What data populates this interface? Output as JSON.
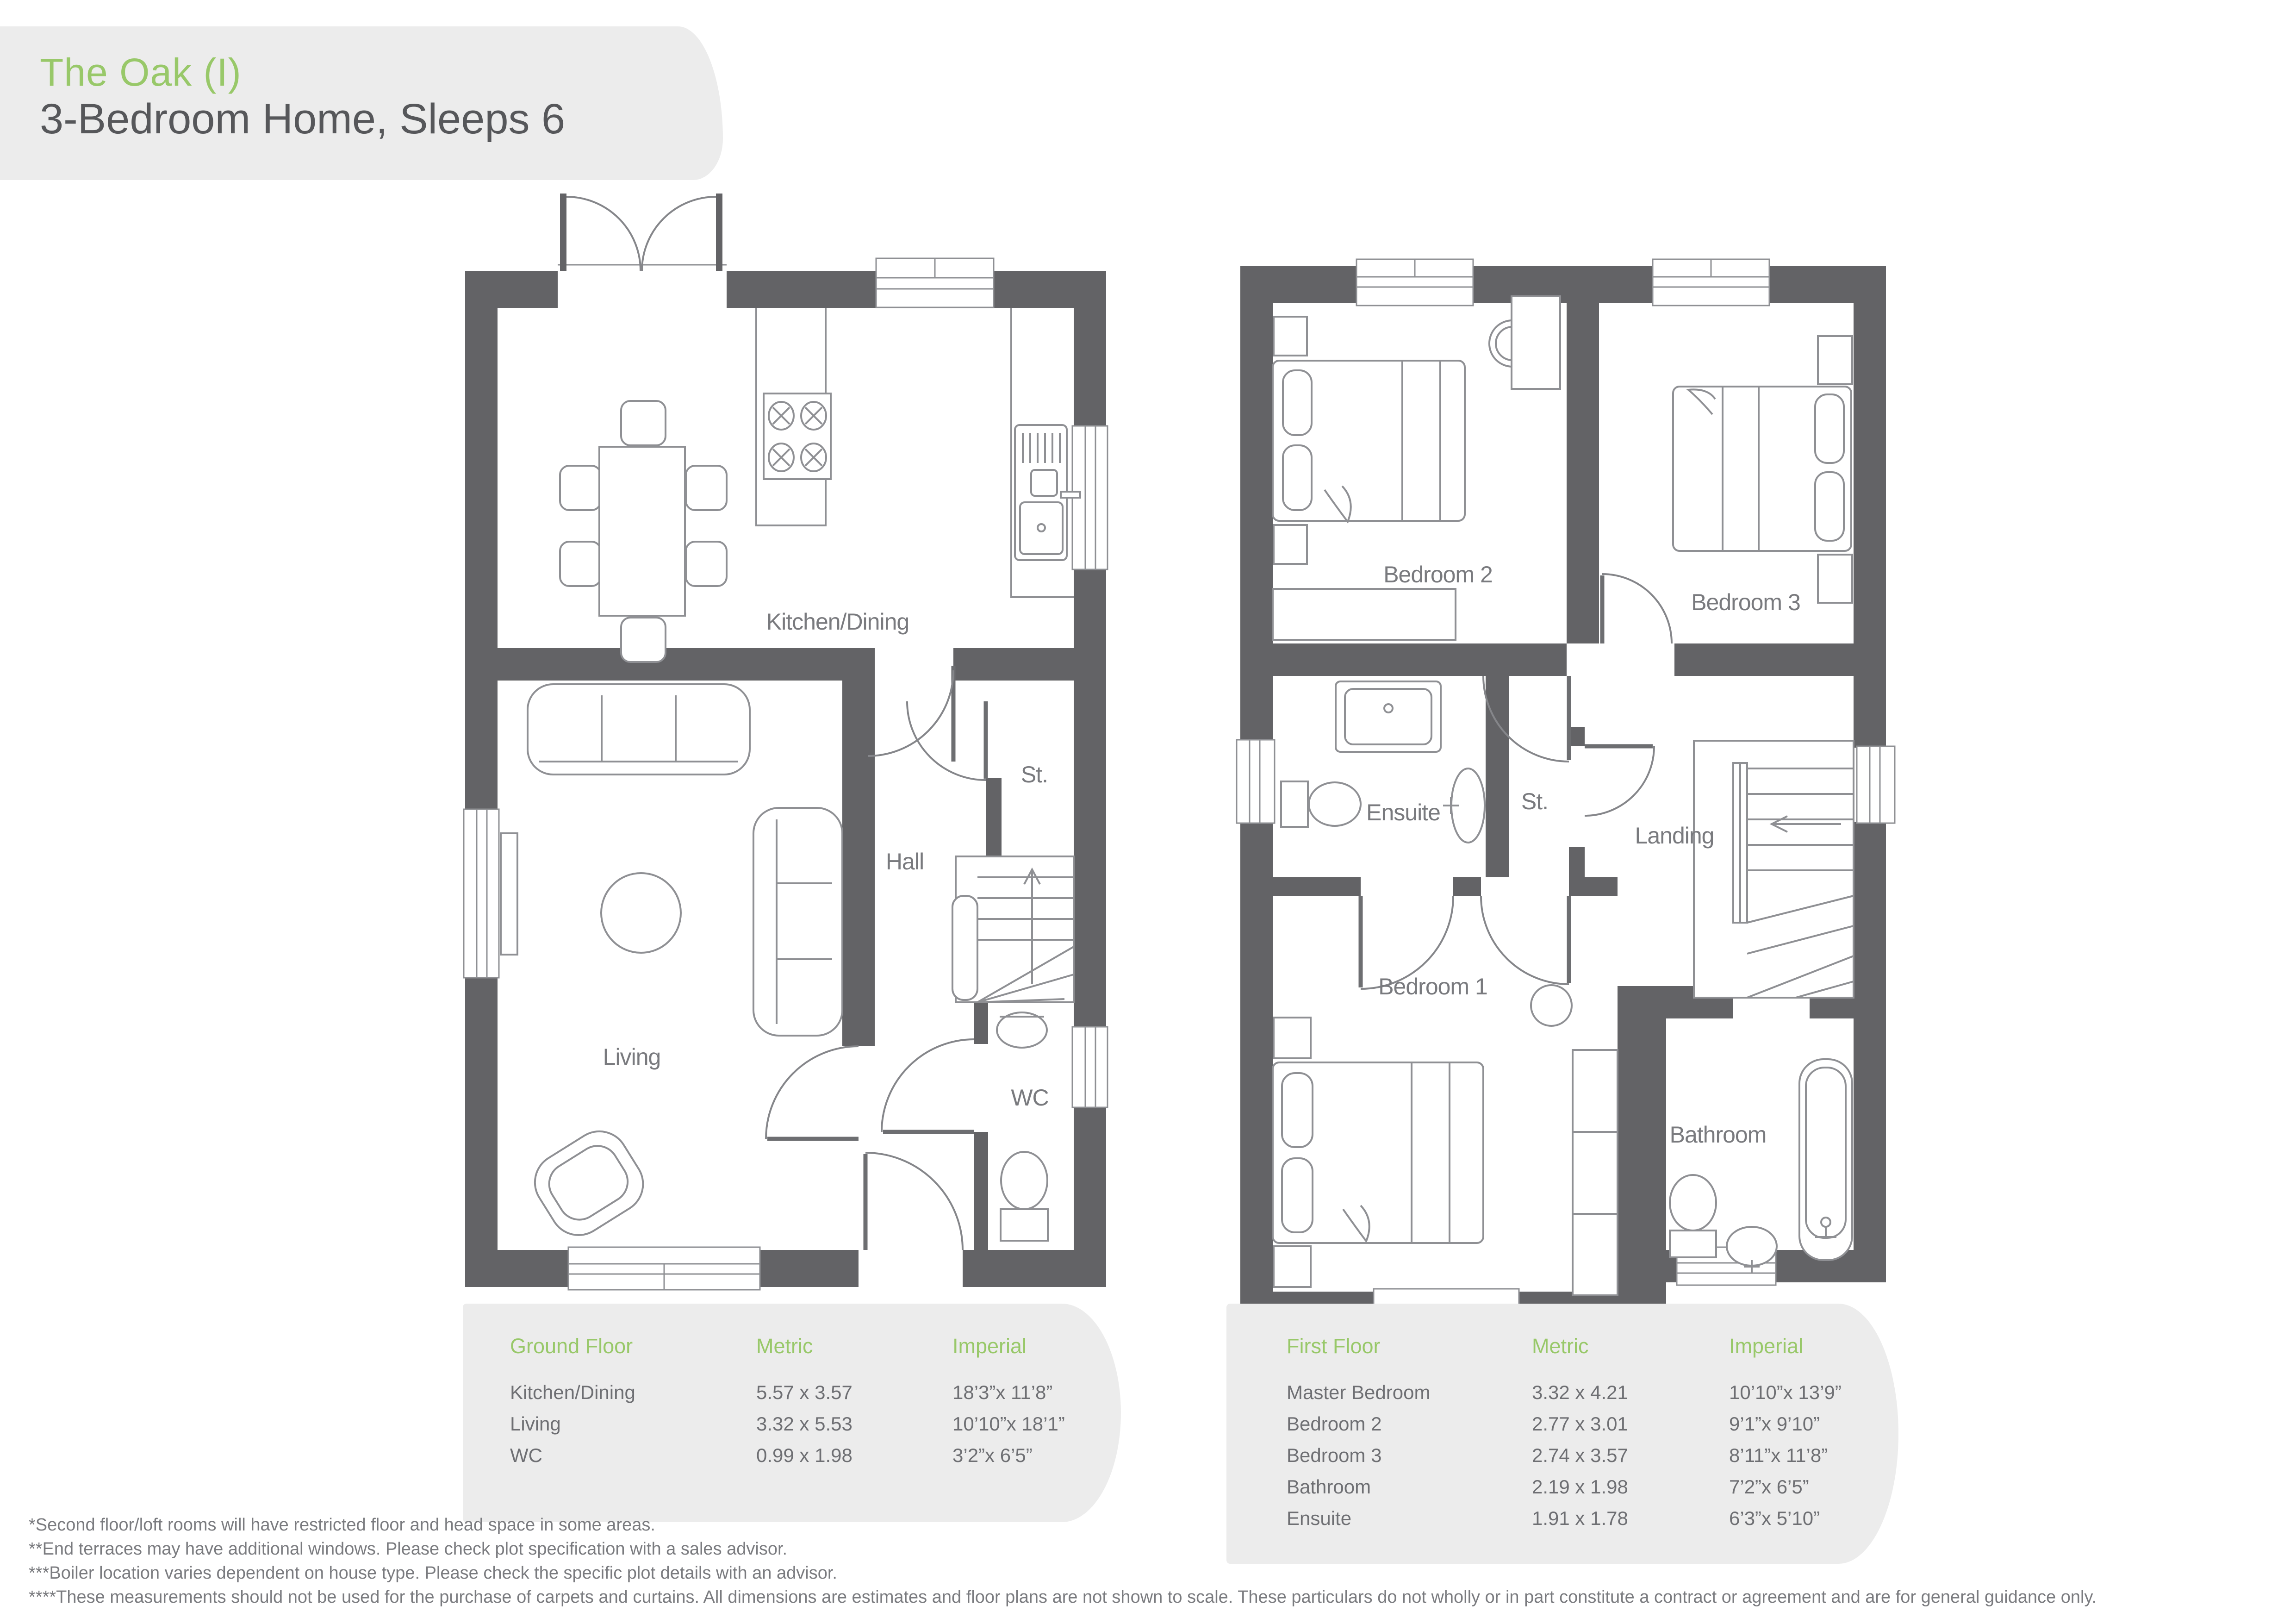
{
  "header": {
    "title": "The Oak (I)",
    "subtitle": "3-Bedroom Home, Sleeps 6"
  },
  "ground_floor": {
    "labels": {
      "kitchen_dining": "Kitchen/Dining",
      "hall": "Hall",
      "storage": "St.",
      "living": "Living",
      "wc": "WC"
    },
    "table": {
      "title": "Ground Floor",
      "col_metric": "Metric",
      "col_imperial": "Imperial",
      "rows": [
        {
          "room": "Kitchen/Dining",
          "metric": "5.57 x 3.57",
          "imperial": "18’3”x 11’8”"
        },
        {
          "room": "Living",
          "metric": "3.32 x 5.53",
          "imperial": "10’10”x 18’1”"
        },
        {
          "room": "WC",
          "metric": "0.99 x 1.98",
          "imperial": "3’2”x 6’5”"
        }
      ]
    }
  },
  "first_floor": {
    "labels": {
      "bedroom2": "Bedroom 2",
      "bedroom3": "Bedroom 3",
      "ensuite": "Ensuite",
      "storage": "St.",
      "landing": "Landing",
      "bedroom1": "Bedroom 1",
      "bathroom": "Bathroom"
    },
    "table": {
      "title": "First Floor",
      "col_metric": "Metric",
      "col_imperial": "Imperial",
      "rows": [
        {
          "room": "Master Bedroom",
          "metric": "3.32 x 4.21",
          "imperial": "10’10”x 13’9”"
        },
        {
          "room": "Bedroom 2",
          "metric": "2.77 x 3.01",
          "imperial": "9’1”x 9’10”"
        },
        {
          "room": "Bedroom 3",
          "metric": "2.74 x 3.57",
          "imperial": "8’11”x 11’8”"
        },
        {
          "room": "Bathroom",
          "metric": "2.19 x 1.98",
          "imperial": "7’2”x 6’5”"
        },
        {
          "room": "Ensuite",
          "metric": "1.91 x 1.78",
          "imperial": "6’3”x 5’10”"
        }
      ]
    }
  },
  "footnotes": [
    "*Second floor/loft rooms will have restricted floor and head space in some areas.",
    "**End terraces may have additional windows. Please check plot specification with a sales advisor.",
    "***Boiler location varies dependent on house type. Please check the specific plot details with an advisor.",
    "****These measurements should not be used for the purchase of carpets and curtains. All dimensions are estimates and floor plans are not shown to scale. These particulars do not wholly or in part constitute a contract or agreement and are for general guidance only."
  ],
  "colors": {
    "accent_green": "#98c869",
    "wall_gray": "#636366",
    "text_gray": "#797a7e",
    "panel_gray": "#ececec"
  }
}
